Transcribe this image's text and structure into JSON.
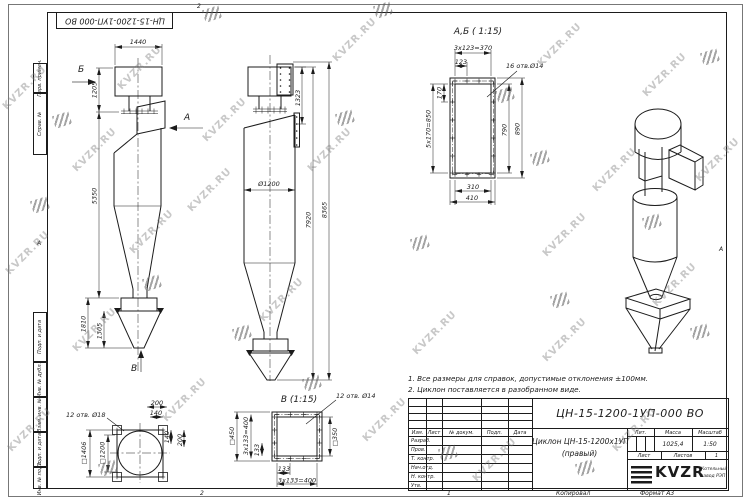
{
  "watermark": {
    "text": "KVZR.RU",
    "text_positions": [
      [
        25,
        88
      ],
      [
        140,
        68
      ],
      [
        95,
        150
      ],
      [
        355,
        40
      ],
      [
        560,
        45
      ],
      [
        665,
        75
      ],
      [
        225,
        120
      ],
      [
        330,
        150
      ],
      [
        28,
        253
      ],
      [
        152,
        232
      ],
      [
        615,
        170
      ],
      [
        565,
        235
      ],
      [
        95,
        330
      ],
      [
        282,
        300
      ],
      [
        675,
        285
      ],
      [
        30,
        430
      ],
      [
        185,
        400
      ],
      [
        385,
        420
      ],
      [
        495,
        460
      ],
      [
        635,
        430
      ],
      [
        565,
        340
      ],
      [
        435,
        333
      ],
      [
        718,
        160
      ],
      [
        210,
        190
      ]
    ],
    "icon_positions": [
      [
        212,
        14
      ],
      [
        383,
        10
      ],
      [
        505,
        95
      ],
      [
        540,
        158
      ],
      [
        420,
        243
      ],
      [
        312,
        383
      ],
      [
        152,
        283
      ],
      [
        40,
        205
      ],
      [
        652,
        222
      ],
      [
        242,
        333
      ],
      [
        108,
        468
      ],
      [
        448,
        453
      ],
      [
        585,
        468
      ],
      [
        700,
        332
      ],
      [
        62,
        120
      ],
      [
        345,
        118
      ],
      [
        710,
        57
      ],
      [
        560,
        300
      ]
    ]
  },
  "frame_zones": {
    "top": "2",
    "bottom": "2",
    "left": "А",
    "right": "А"
  },
  "stamp_top": "ЦН-15-1200-1УП-000 ВО",
  "margin_labels": [
    "Перв. примен.",
    "Справ. №",
    "Подп. и дата",
    "Инв. № дубл.",
    "Взам. инв. №",
    "Подп. и дата",
    "Инв. № подл."
  ],
  "view_letters": {
    "a": "А",
    "b": "Б",
    "v": "В"
  },
  "view_titles": {
    "ab": "А,Б ( 1:15)",
    "v": "В (1:15)"
  },
  "dims": {
    "side_w": "1440",
    "side_h1": "1205",
    "side_h2": "5350",
    "side_h3": "1810",
    "side_h4": "1305",
    "front_h1": "1323",
    "front_d": "Ø1200",
    "front_h2": "7920",
    "front_h3": "8365",
    "ab_top": "3x123=370",
    "ab_top2": "123",
    "ab_holes": "16 отв.Ø14",
    "ab_l1": "170",
    "ab_l2": "5x170=850",
    "ab_r1": "790",
    "ab_r2": "890",
    "ab_b1": "310",
    "ab_b2": "410",
    "bl_holes": "12 отв. Ø18",
    "bl_t1": "200",
    "bl_t2": "140",
    "bl_r1": "140",
    "bl_r2": "200",
    "bl_sq1": "□1406",
    "bl_sq2": "□1200",
    "v_holes": "12 отв. Ø14",
    "v_sq1": "□450",
    "v_sq2": "□350",
    "v_l1": "3x133=400",
    "v_l2": "133",
    "v_b1": "133",
    "v_b2": "3x133=400"
  },
  "notes": [
    "1. Все размеры для справок, допустимые отклонения ±100мм.",
    "2. Циклон поставляется в разобранном виде."
  ],
  "title_block": {
    "doc_number": "ЦН-15-1200-1УП-000 ВО",
    "title_line1": "Циклон ЦН-15-1200х1УП",
    "title_line2": "(правый)",
    "headers": {
      "izm": "Изм.",
      "list": "Лист",
      "doc": "№ докум.",
      "podp": "Подп.",
      "data": "Дата"
    },
    "rows": [
      "Разраб.",
      "Пров.",
      "Т. контр.",
      "Нач.отд.",
      "Н. контр.",
      "Утв."
    ],
    "lit_label": "Лит.",
    "mass_label": "Масса",
    "scale_label": "Масштаб",
    "mass_value": "1025,4",
    "scale_value": "1:50",
    "sheet_label": "Лист",
    "sheets_label": "Листов",
    "sheets_value": "1",
    "logo_text": "KVZR",
    "org_line1": "Котельный",
    "org_line2": "завод РЭП"
  },
  "footer": {
    "zone": "1",
    "copied": "Копировал",
    "format": "Формат А3"
  }
}
